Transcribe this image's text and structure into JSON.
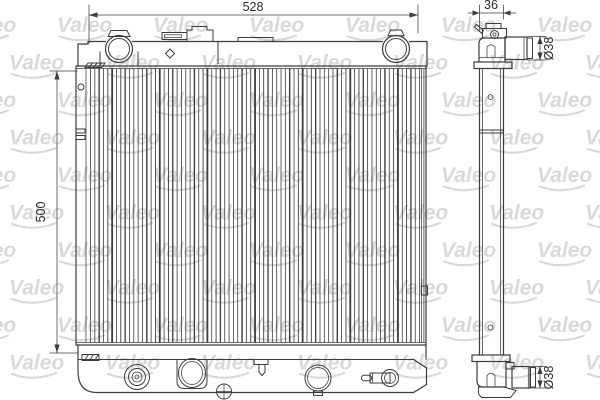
{
  "document": {
    "kind": "technical-drawing",
    "subject": "radiator-two-view-drawing",
    "background_color": "#ffffff",
    "line_color": "#3c3c3c",
    "dim_text_color": "#2b2b2b"
  },
  "watermark": {
    "text": "Valeo",
    "color": "#d9d9d9"
  },
  "front_view": {
    "width_dim": "528",
    "height_dim": "500"
  },
  "side_view": {
    "depth_dim": "36",
    "top_pipe_dia": "Ø38",
    "bottom_pipe_dia": "Ø38"
  }
}
